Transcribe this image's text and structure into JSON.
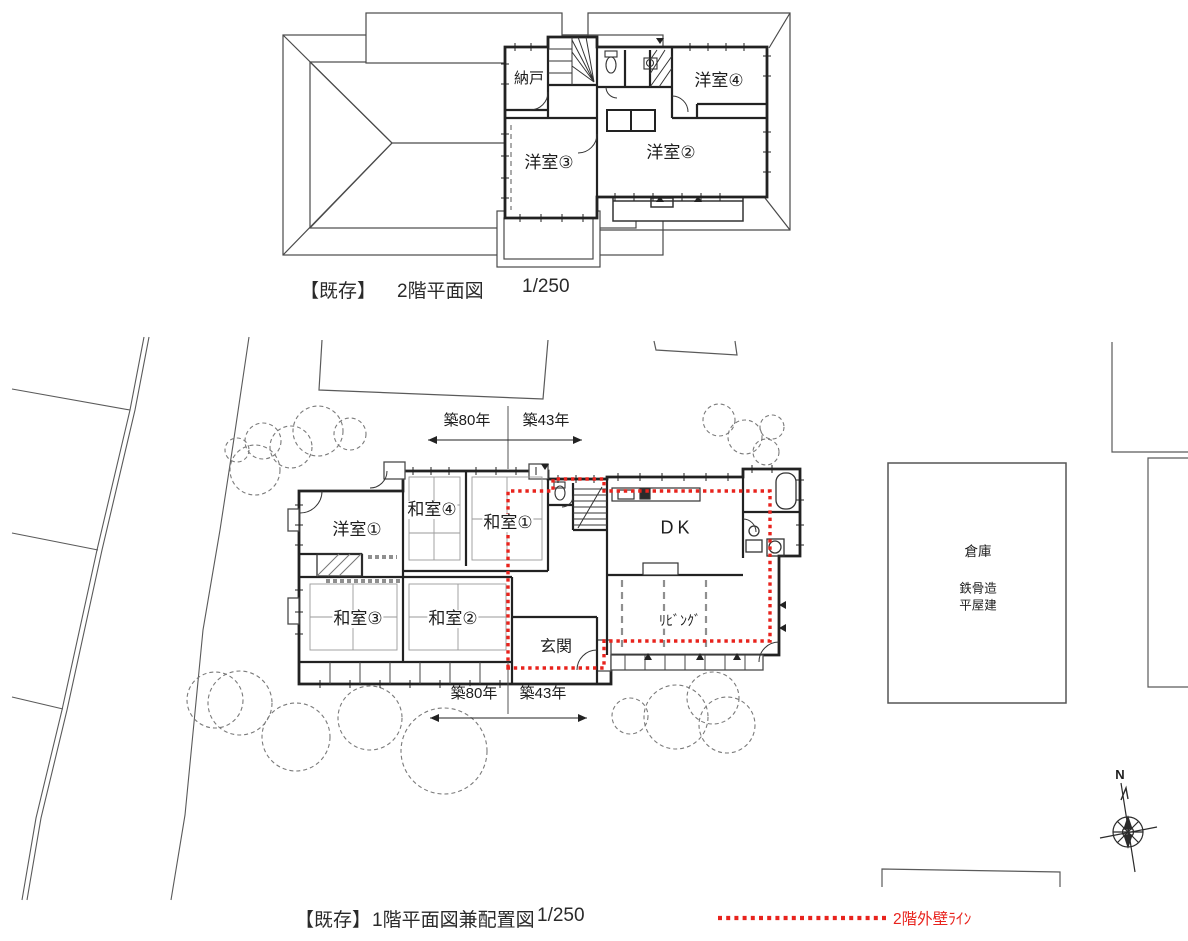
{
  "colors": {
    "accent_red": "#E8231D",
    "ink": "#2B2B2B"
  },
  "floor2": {
    "caption": {
      "tag": "【既存】",
      "title": "2階平面図",
      "scale": "1/250"
    },
    "rooms": {
      "nando": "納戸",
      "yoshitsu3": "洋室③",
      "yoshitsu2": "洋室②",
      "yoshitsu4": "洋室④"
    }
  },
  "floor1": {
    "caption": {
      "tag": "【既存】",
      "title": "1階平面図兼配置図",
      "scale": "1/250"
    },
    "rooms": {
      "yoshitsu1": "洋室①",
      "washitsu4": "和室④",
      "washitsu1": "和室①",
      "dk": "DK",
      "washitsu3": "和室③",
      "washitsu2": "和室②",
      "living": "ﾘﾋﾞﾝｸﾞ",
      "genkan": "玄関"
    },
    "annotations": {
      "age_left": "築80年",
      "age_right": "築43年"
    }
  },
  "site": {
    "warehouse": {
      "name": "倉庫",
      "structure": "鉄骨造",
      "stories": "平屋建"
    },
    "compass_north": "N"
  },
  "legend": {
    "label": "2階外壁ﾗｲﾝ"
  }
}
